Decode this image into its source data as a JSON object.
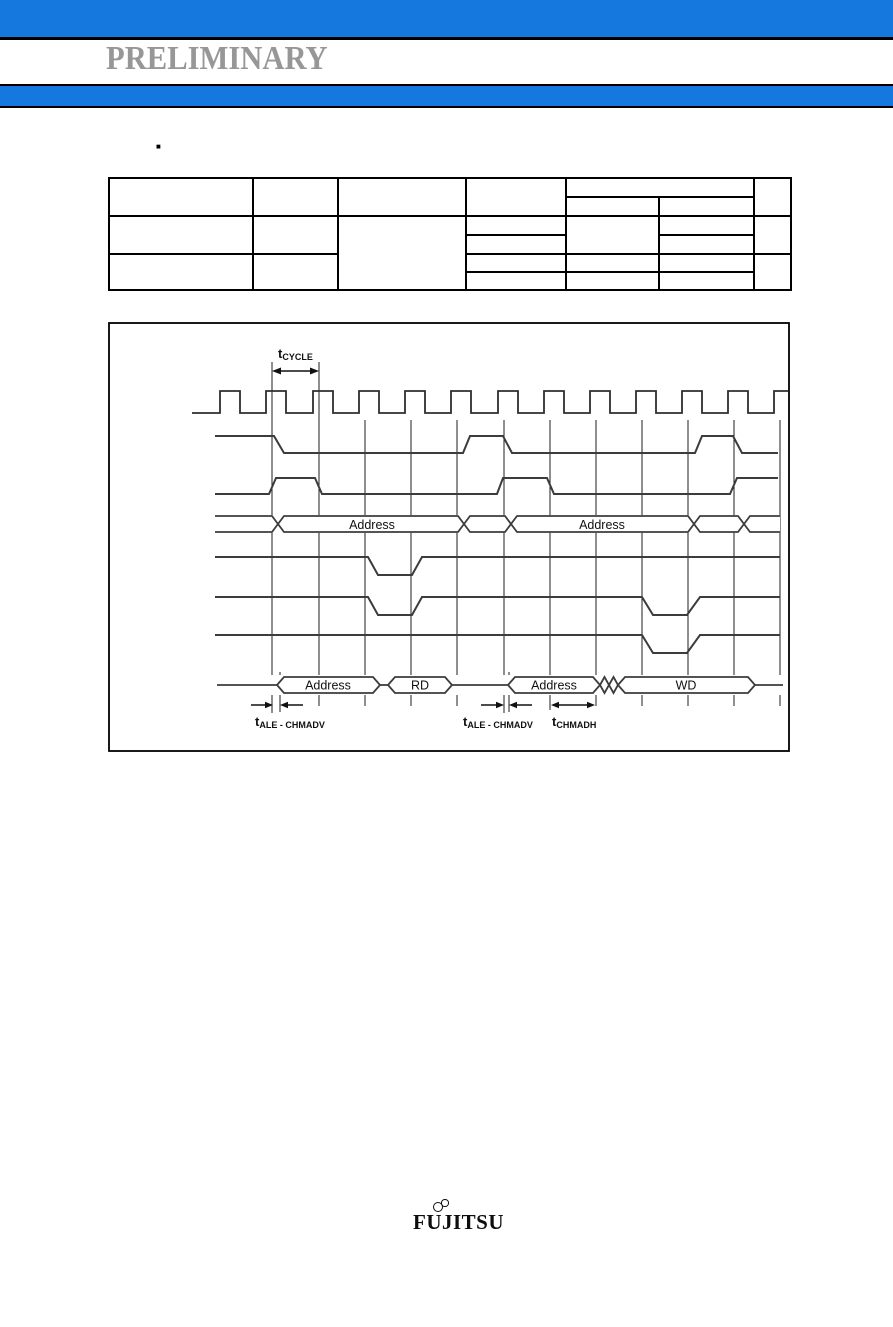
{
  "header": {
    "watermark": "PRELIMINARY"
  },
  "colors": {
    "banner_blue": "#1478df",
    "watermark_gray": "#979797"
  },
  "section": {
    "bullet": "■"
  },
  "timing_diagram": {
    "t_cycle": {
      "base": "t",
      "sub": "CYCLE"
    },
    "t_ale_chmadv_first": {
      "base": "t",
      "sub": "ALE - CHMADV"
    },
    "t_ale_chmadv_second": {
      "base": "t",
      "sub": "ALE - CHMADV"
    },
    "t_chmadh": {
      "base": "t",
      "sub": "CHMADH"
    },
    "address_bus_segments": [
      "Address",
      "Address"
    ],
    "data_bus_segments": [
      "Address",
      "RD",
      "Address",
      "WD"
    ]
  },
  "footer": {
    "logo_text": "FUJITSU"
  }
}
